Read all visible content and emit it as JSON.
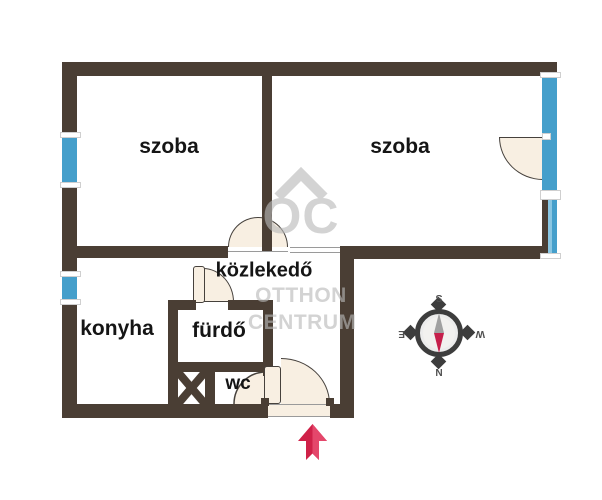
{
  "rooms": {
    "room_left": "szoba",
    "room_right": "szoba",
    "hallway": "közlekedő",
    "kitchen": "konyha",
    "bathroom": "fürdő",
    "toilet": "wc"
  },
  "watermark": {
    "monogram": "OC",
    "line1": "OTTHON",
    "line2": "CENTRUM"
  },
  "compass": {
    "north": "N",
    "south": "S",
    "east": "E",
    "west": "W"
  },
  "colors": {
    "wall": "#4a3e34",
    "window": "#459fcb",
    "window-light": "#8ac6e2",
    "door-fill": "#f8efe2",
    "door-line": "#46413c",
    "watermark": "#b9b9b9",
    "arrow-dark": "#cf2148",
    "arrow-light": "#e4476b",
    "compass-ring": "#3d3d3d",
    "needle-red": "#c51f4b",
    "needle-gray": "#a0a0a0"
  }
}
